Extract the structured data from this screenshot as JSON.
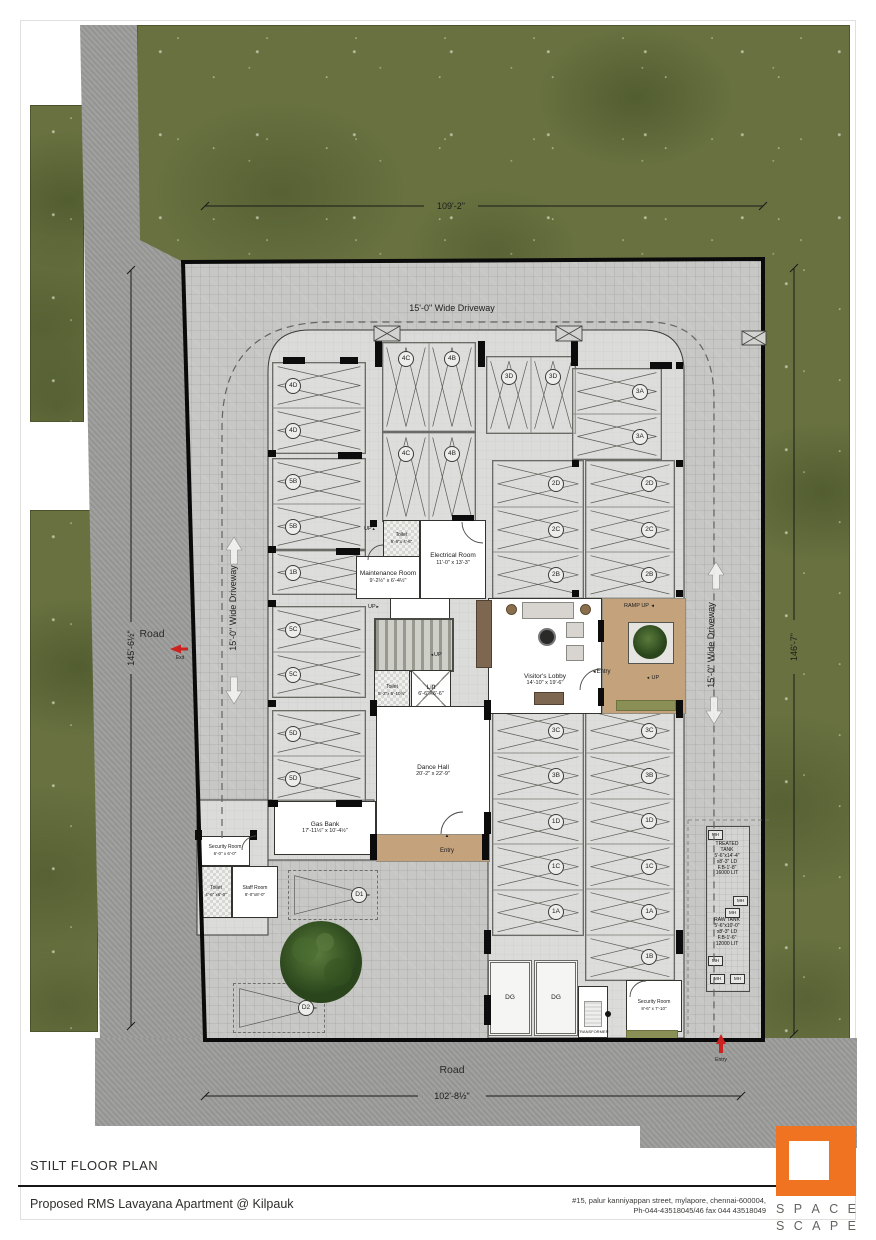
{
  "site": {
    "dim_top": "109'-2\"",
    "dim_left": "145'-6½\"",
    "dim_right": "146'-7\"",
    "dim_bottom": "102'-8½\"",
    "road": "Road",
    "driveway": "15'-0\" Wide Driveway"
  },
  "labels": {
    "exit": "Exit",
    "entry": "Entry",
    "ramp_up": "RAMP UP",
    "up": "UP"
  },
  "icons": {
    "left_arrow": "◄",
    "right_arrow": "►",
    "up_arrow": "▲"
  },
  "parking_groups": [
    {
      "id": "left-4d",
      "x": 272,
      "y": 362,
      "w": 92,
      "h": 90,
      "dir": "h",
      "lp": 0.22,
      "stalls": [
        "4D",
        "4D"
      ]
    },
    {
      "id": "left-5b",
      "x": 272,
      "y": 458,
      "w": 92,
      "h": 90,
      "dir": "h",
      "lp": 0.22,
      "stalls": [
        "5B",
        "5B"
      ]
    },
    {
      "id": "left-1b",
      "x": 272,
      "y": 550,
      "w": 92,
      "h": 43,
      "dir": "h",
      "lp": 0.22,
      "stalls": [
        "1B"
      ]
    },
    {
      "id": "left-5c",
      "x": 272,
      "y": 606,
      "w": 92,
      "h": 90,
      "dir": "h",
      "lp": 0.22,
      "stalls": [
        "5C",
        "5C"
      ]
    },
    {
      "id": "left-5d",
      "x": 272,
      "y": 710,
      "w": 92,
      "h": 90,
      "dir": "h",
      "lp": 0.22,
      "stalls": [
        "5D",
        "5D"
      ]
    },
    {
      "id": "mid-4c4b-top",
      "x": 382,
      "y": 342,
      "w": 92,
      "h": 88,
      "dir": "v",
      "lp": 0.18,
      "stalls": [
        "4C",
        "4B"
      ]
    },
    {
      "id": "mid-4c4b-bot",
      "x": 382,
      "y": 432,
      "w": 92,
      "h": 88,
      "dir": "v",
      "lp": 0.24,
      "stalls": [
        "4C",
        "4B"
      ]
    },
    {
      "id": "mid-3d",
      "x": 486,
      "y": 356,
      "w": 88,
      "h": 76,
      "dir": "v",
      "lp": 0.26,
      "stalls": [
        "3D",
        "3D"
      ]
    },
    {
      "id": "right-3a",
      "x": 572,
      "y": 368,
      "w": 88,
      "h": 90,
      "dir": "h",
      "lp": 0.76,
      "stalls": [
        "3A",
        "3A"
      ]
    },
    {
      "id": "rcol1-left",
      "x": 492,
      "y": 460,
      "w": 90,
      "h": 137,
      "dir": "h",
      "lp": 0.7,
      "stalls": [
        "2D",
        "2C",
        "2B"
      ]
    },
    {
      "id": "rcol1-right",
      "x": 585,
      "y": 460,
      "w": 88,
      "h": 137,
      "dir": "h",
      "lp": 0.72,
      "stalls": [
        "2D",
        "2C",
        "2B"
      ]
    },
    {
      "id": "rcol2-left",
      "x": 492,
      "y": 707,
      "w": 90,
      "h": 227,
      "dir": "h",
      "lp": 0.7,
      "stalls": [
        "3C",
        "3B",
        "1D",
        "1C",
        "1A"
      ]
    },
    {
      "id": "rcol2-right",
      "x": 585,
      "y": 707,
      "w": 88,
      "h": 272,
      "dir": "h",
      "lp": 0.72,
      "stalls": [
        "3C",
        "3B",
        "1D",
        "1C",
        "1A",
        "1B"
      ]
    },
    {
      "id": "d1",
      "x": 288,
      "y": 870,
      "w": 88,
      "h": 48,
      "dir": "h",
      "lp": 0.8,
      "dashed": true,
      "tri": true,
      "stalls": [
        "D1"
      ]
    },
    {
      "id": "d2",
      "x": 233,
      "y": 983,
      "w": 90,
      "h": 48,
      "dir": "h",
      "lp": 0.8,
      "dashed": true,
      "tri": true,
      "stalls": [
        "D2"
      ]
    }
  ],
  "rooms": [
    {
      "id": "toilet-top",
      "x": 383,
      "y": 520,
      "w": 35,
      "h": 36,
      "cls": "checker sm",
      "label": "Toilet",
      "dims": "5'-6\"x 4'-6\""
    },
    {
      "id": "maintenance-room",
      "x": 356,
      "y": 556,
      "w": 62,
      "h": 41,
      "cls": "",
      "label": "Maintenance Room",
      "dims": "9'-2½\" x 6'-4½\""
    },
    {
      "id": "electrical-room",
      "x": 420,
      "y": 520,
      "w": 64,
      "h": 77,
      "cls": "",
      "label": "Electrical Room",
      "dims": "11'-0\" x 13'-3\""
    },
    {
      "id": "stair-landing",
      "x": 390,
      "y": 598,
      "w": 58,
      "h": 20,
      "cls": "",
      "label": "",
      "dims": ""
    },
    {
      "id": "staircase",
      "x": 374,
      "y": 618,
      "w": 76,
      "h": 50,
      "cls": "stairs",
      "label": "",
      "dims": ""
    },
    {
      "id": "toilet-mid",
      "x": 374,
      "y": 670,
      "w": 34,
      "h": 40,
      "cls": "checker sm",
      "label": "Toilet",
      "dims": "5'-2\"x 6'-10½\""
    },
    {
      "id": "lift",
      "x": 411,
      "y": 670,
      "w": 38,
      "h": 40,
      "cls": "lift",
      "label": "Lift",
      "dims": "6'-6\"X6'-6\""
    },
    {
      "id": "ramp-area",
      "x": 602,
      "y": 598,
      "w": 82,
      "h": 114,
      "cls": "tan",
      "label": "",
      "dims": ""
    },
    {
      "id": "visitors-lobby",
      "x": 488,
      "y": 598,
      "w": 114,
      "h": 116,
      "cls": "lobby",
      "label": "Visitor's Lobby",
      "dims": "14'-10\" x 19'-6\""
    },
    {
      "id": "lobby-feature-wall",
      "x": 476,
      "y": 600,
      "w": 14,
      "h": 66,
      "cls": "wood",
      "label": "",
      "dims": ""
    },
    {
      "id": "dance-hall",
      "x": 376,
      "y": 706,
      "w": 112,
      "h": 128,
      "cls": "",
      "label": "Dance Hall",
      "dims": "20'-2\" x 22'-9\""
    },
    {
      "id": "entry-ramp",
      "x": 376,
      "y": 834,
      "w": 112,
      "h": 26,
      "cls": "tan",
      "label": "",
      "dims": ""
    },
    {
      "id": "gas-bank",
      "x": 274,
      "y": 801,
      "w": 100,
      "h": 52,
      "cls": "",
      "label": "Gas Bank",
      "dims": "17'-11½\" x 10'-4½\""
    },
    {
      "id": "security-room-1",
      "x": 200,
      "y": 836,
      "w": 48,
      "h": 28,
      "cls": "sm",
      "label": "Security Room",
      "dims": "6'-0\" x 6'-0\""
    },
    {
      "id": "toilet-low",
      "x": 200,
      "y": 866,
      "w": 30,
      "h": 50,
      "cls": "checker sm",
      "label": "Toilet",
      "dims": "4'-6\" x6'-0\""
    },
    {
      "id": "staff-room",
      "x": 232,
      "y": 866,
      "w": 44,
      "h": 50,
      "cls": "sm",
      "label": "Staff Room",
      "dims": "8'-0\"x8'-0\""
    },
    {
      "id": "dg-1",
      "x": 488,
      "y": 960,
      "w": 38,
      "h": 70,
      "cls": "dg",
      "label": "DG",
      "dims": ""
    },
    {
      "id": "dg-2",
      "x": 534,
      "y": 960,
      "w": 38,
      "h": 70,
      "cls": "dg",
      "label": "DG",
      "dims": ""
    },
    {
      "id": "transformer",
      "x": 578,
      "y": 986,
      "w": 30,
      "h": 52,
      "cls": "transformer",
      "label": "TRANSFORMER",
      "dims": ""
    },
    {
      "id": "security-room-2",
      "x": 626,
      "y": 980,
      "w": 54,
      "h": 50,
      "cls": "sm",
      "label": "Security Room",
      "dims": "8'-6\" x 7'-10\""
    },
    {
      "id": "green-strip-ramp",
      "x": 616,
      "y": 700,
      "w": 58,
      "h": 9,
      "cls": "green",
      "label": "",
      "dims": ""
    },
    {
      "id": "green-strip-gate",
      "x": 626,
      "y": 1030,
      "w": 50,
      "h": 9,
      "cls": "green",
      "label": "",
      "dims": ""
    }
  ],
  "piers": [
    [
      283,
      357,
      22,
      7
    ],
    [
      340,
      357,
      18,
      7
    ],
    [
      375,
      341,
      7,
      26
    ],
    [
      478,
      341,
      7,
      26
    ],
    [
      571,
      338,
      7,
      28
    ],
    [
      650,
      362,
      22,
      7
    ],
    [
      268,
      450,
      8,
      7
    ],
    [
      338,
      452,
      24,
      7
    ],
    [
      268,
      546,
      8,
      7
    ],
    [
      336,
      548,
      24,
      7
    ],
    [
      268,
      600,
      8,
      7
    ],
    [
      268,
      700,
      8,
      7
    ],
    [
      336,
      800,
      26,
      7
    ],
    [
      268,
      800,
      10,
      7
    ],
    [
      484,
      700,
      7,
      20
    ],
    [
      484,
      812,
      7,
      22
    ],
    [
      484,
      930,
      7,
      24
    ],
    [
      676,
      930,
      7,
      24
    ],
    [
      484,
      995,
      7,
      30
    ],
    [
      676,
      700,
      7,
      18
    ],
    [
      598,
      620,
      6,
      22
    ],
    [
      598,
      688,
      6,
      18
    ],
    [
      370,
      520,
      7,
      7
    ],
    [
      452,
      515,
      22,
      6
    ],
    [
      370,
      700,
      7,
      16
    ],
    [
      195,
      830,
      7,
      10
    ],
    [
      250,
      830,
      7,
      10
    ],
    [
      370,
      834,
      7,
      26
    ],
    [
      482,
      834,
      7,
      26
    ],
    [
      572,
      460,
      7,
      7
    ],
    [
      572,
      590,
      7,
      7
    ],
    [
      676,
      460,
      7,
      7
    ],
    [
      676,
      590,
      7,
      7
    ],
    [
      676,
      362,
      7,
      7
    ]
  ],
  "tanks": {
    "treated": "TREATED\nTANK\n5'-6\"x14'-4\"\nx8'-3\" LD\nF.B-1'-8\"\n16000 LIT",
    "raw": "RAW TANK\n5'-6\"x10'-0\"\nx8'-3\" LD\nF.B-1'-6\"\n12000 LIT",
    "mh": "MH"
  },
  "footer": {
    "plan_title": "STILT FLOOR PLAN",
    "project": "Proposed RMS Lavayana Apartment @ Kilpauk",
    "address_line1": "#15, palur kanniyappan street, mylapore, chennai-600004,",
    "address_line2": "Ph-044-43518045/46 fax 044 43518049",
    "logo_word1": "SPACE",
    "logo_word2": "SCAPE"
  },
  "colors": {
    "grass": "#68713f",
    "road": "#9c9c9a",
    "pavers": "#c7c7c5",
    "floor": "#dbdbd9",
    "tan": "#c3a27c",
    "logo_orange": "#ef7320",
    "red_arrow": "#cc2320"
  }
}
